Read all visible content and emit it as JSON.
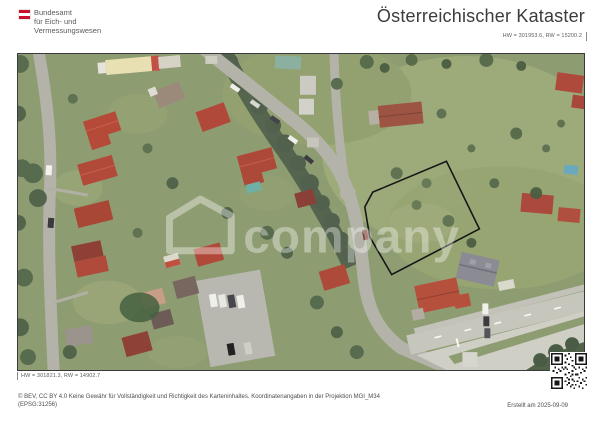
{
  "header": {
    "logo_line1": "Bundesamt",
    "logo_line2": "für Eich- und",
    "logo_line3": "Vermessungswesen",
    "title": "Österreichischer Kataster"
  },
  "map_sheet": {
    "coord_top_right": "HW = 301953.6, RW = 15200.2",
    "coord_bottom_left": "HW = 301821.3, RW = 14902.7",
    "watermark_text": "company"
  },
  "footer": {
    "license_line1": "© BEV, CC BY 4.0 Keine Gewähr für Vollständigkeit und Richtigkeit des Karteninhaltes. Koordinatenangaben in der Projektion MGI_M34",
    "license_line2": "(EPSG:31256)",
    "created_label": "Erstellt am 2025-09-09"
  },
  "colors": {
    "brand_red": "#c8102e",
    "parcel_outline": "#161616",
    "road_gray": "#b3b3aa",
    "meadow_green": "#9aa878"
  }
}
